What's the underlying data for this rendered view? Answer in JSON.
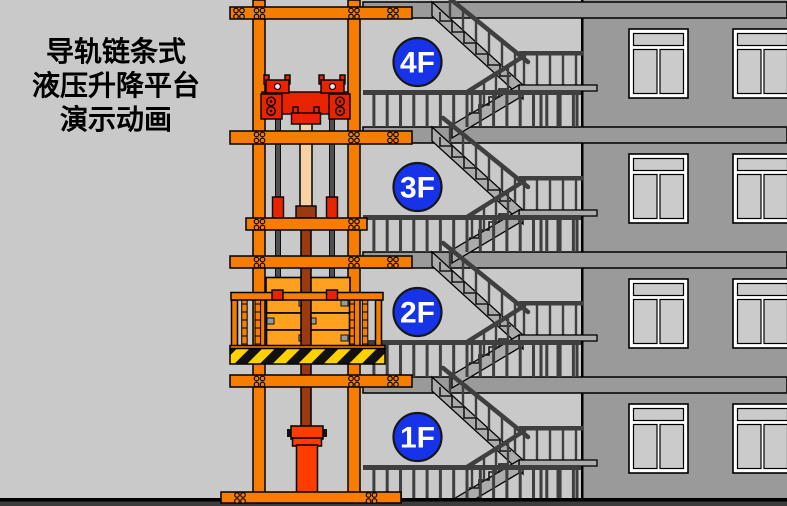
{
  "title": {
    "lines": [
      "导轨链条式",
      "液压升降平台",
      "演示动画"
    ]
  },
  "floors": [
    {
      "label": "4F"
    },
    {
      "label": "3F"
    },
    {
      "label": "2F"
    },
    {
      "label": "1F"
    }
  ],
  "colors": {
    "bg": "#c9c9c9",
    "facade": "#9a9a9a",
    "slab": "#9a9a9a",
    "stair": "#ababab",
    "rail": "#3f3f3f",
    "orange": "#f57d00",
    "carriage": "#e82400",
    "cylinder": "#ff3c00",
    "rod_upper": "#f8d2a4",
    "rod_lower": "#9a3a10",
    "crate": "#ffa01e",
    "chain": "#4f4f4f",
    "hazard_yellow": "#ffd200",
    "hazard_black": "#111111",
    "floor_badge": "#1733e8",
    "badge_text": "#ffffff",
    "title_text": "#000000",
    "ground": "#3c3c3c",
    "window_pane": "#cbcbcb",
    "window_frame": "#ffffff"
  }
}
